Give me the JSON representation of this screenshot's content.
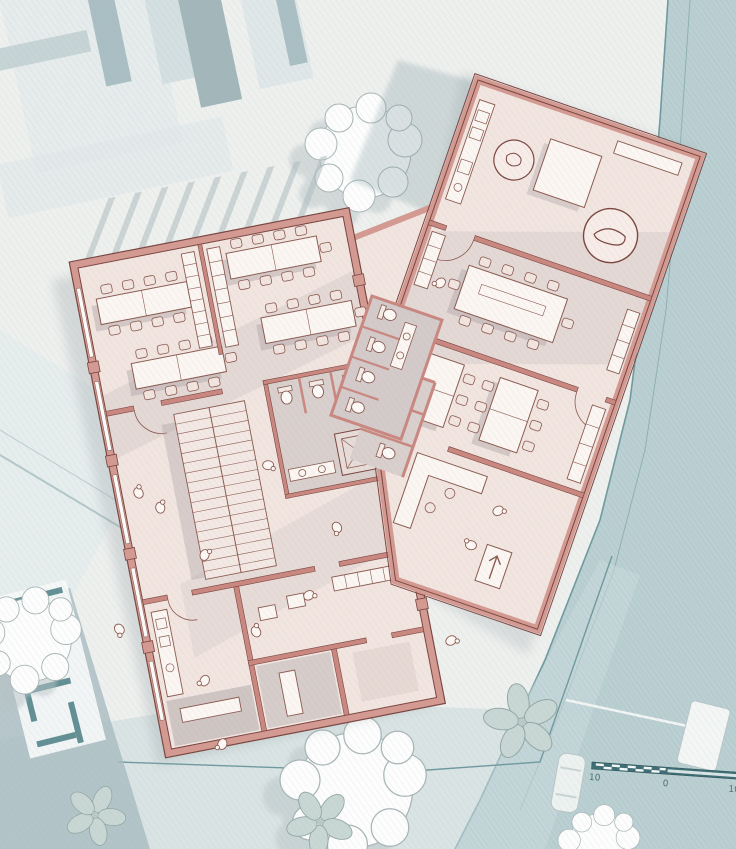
{
  "plan": {
    "scale_bar": {
      "labels": [
        "10",
        "0",
        "10"
      ]
    },
    "palette": {
      "paper": "#eef0ee",
      "context_light": "#e2e9ea",
      "context_mid": "#cdd9db",
      "context_dark": "#a3b8bc",
      "road_fill": "#b7cdd0",
      "road_edge": "#6f999e",
      "plaza_fill": "#c9d9da",
      "neighbor_wall_teal": "#4a7e84",
      "wall_fill": "#d49a92",
      "wall_outline": "#7a453f",
      "interior_wall": "#c9877f",
      "floor": "#f2e5e0",
      "floor_shaded": "#d9cfcd",
      "floor_dark": "#cfc5c2",
      "furniture_fill": "#fbf6f2",
      "furniture_stroke": "#8a5a50",
      "chair_fill": "#f2e4df",
      "cast_shadow": "#a29aa0",
      "tree_fill": "#fcfdfc",
      "tree_stroke": "#a9b5b6",
      "tree_shadow": "#b9c4c6",
      "scale_bar_fill": "#3f6d74",
      "car_fill": "#edf2f1"
    },
    "icon_names": [
      "tree-canopy-icon",
      "flower-paving-icon",
      "car-icon",
      "truck-icon",
      "scale-bar",
      "stair-icon",
      "toilet-icon",
      "sink-icon",
      "elevator-icon",
      "desk-group-icon",
      "conference-table-icon",
      "reception-desk-icon",
      "kitchen-counter-icon",
      "rug-icon",
      "door-swing-icon",
      "entrance-arrow-icon",
      "person-doodle-icon",
      "lounge-chair-icon"
    ]
  }
}
